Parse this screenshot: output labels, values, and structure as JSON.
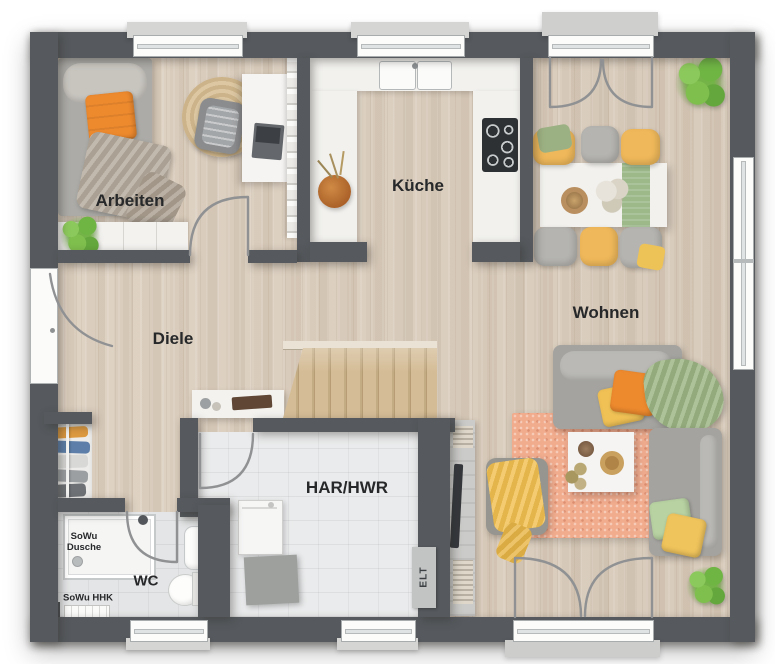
{
  "floorplan": {
    "type": "residential-ground-floor-plan",
    "rooms": {
      "arbeiten": {
        "label": "Arbeiten",
        "furniture": [
          "daybed",
          "orange-pillow",
          "throw-blanket",
          "round-jute-rug",
          "office-chair",
          "desk",
          "laptop",
          "bookshelf",
          "sideboard",
          "potted-plant"
        ]
      },
      "kueche": {
        "label": "Küche",
        "furniture": [
          "u-shaped-counter",
          "double-sink",
          "cooktop",
          "flower-vase"
        ]
      },
      "diele": {
        "label": "Diele",
        "furniture": [
          "entrance-door",
          "coat-rack",
          "console-table",
          "staircase"
        ]
      },
      "wohnen": {
        "label": "Wohnen",
        "furniture": [
          "dining-table",
          "table-runner",
          "dining-chairs",
          "sofa",
          "loveseat",
          "armchair",
          "coffee-table",
          "area-rug",
          "tv-lowboard",
          "tv",
          "house-plants",
          "french-doors"
        ]
      },
      "har_hwr": {
        "label": "HAR/HWR",
        "furniture": [
          "washing-machine",
          "dryer",
          "electrical-panel"
        ]
      },
      "wc": {
        "label": "WC",
        "furniture": [
          "shower",
          "hand-basin",
          "toilet",
          "radiator"
        ]
      }
    },
    "annotations": {
      "shower_line1": "SoWu",
      "shower_line2": "Dusche",
      "heater_label": "SoWu HHK",
      "electrical_label": "ELT"
    },
    "palette": {
      "wall": "#565a5e",
      "wood_floor": "#d7c9b8",
      "tile_floor": "#eaebec",
      "counter": "#f2f1ee",
      "accent_orange": "#ee8a2e",
      "accent_yellow": "#f0c155",
      "accent_green": "#9cb584",
      "rug_salmon": "#f1ac8e",
      "rug_jute": "#d7c29c",
      "plant_green": "#6fae46"
    }
  }
}
